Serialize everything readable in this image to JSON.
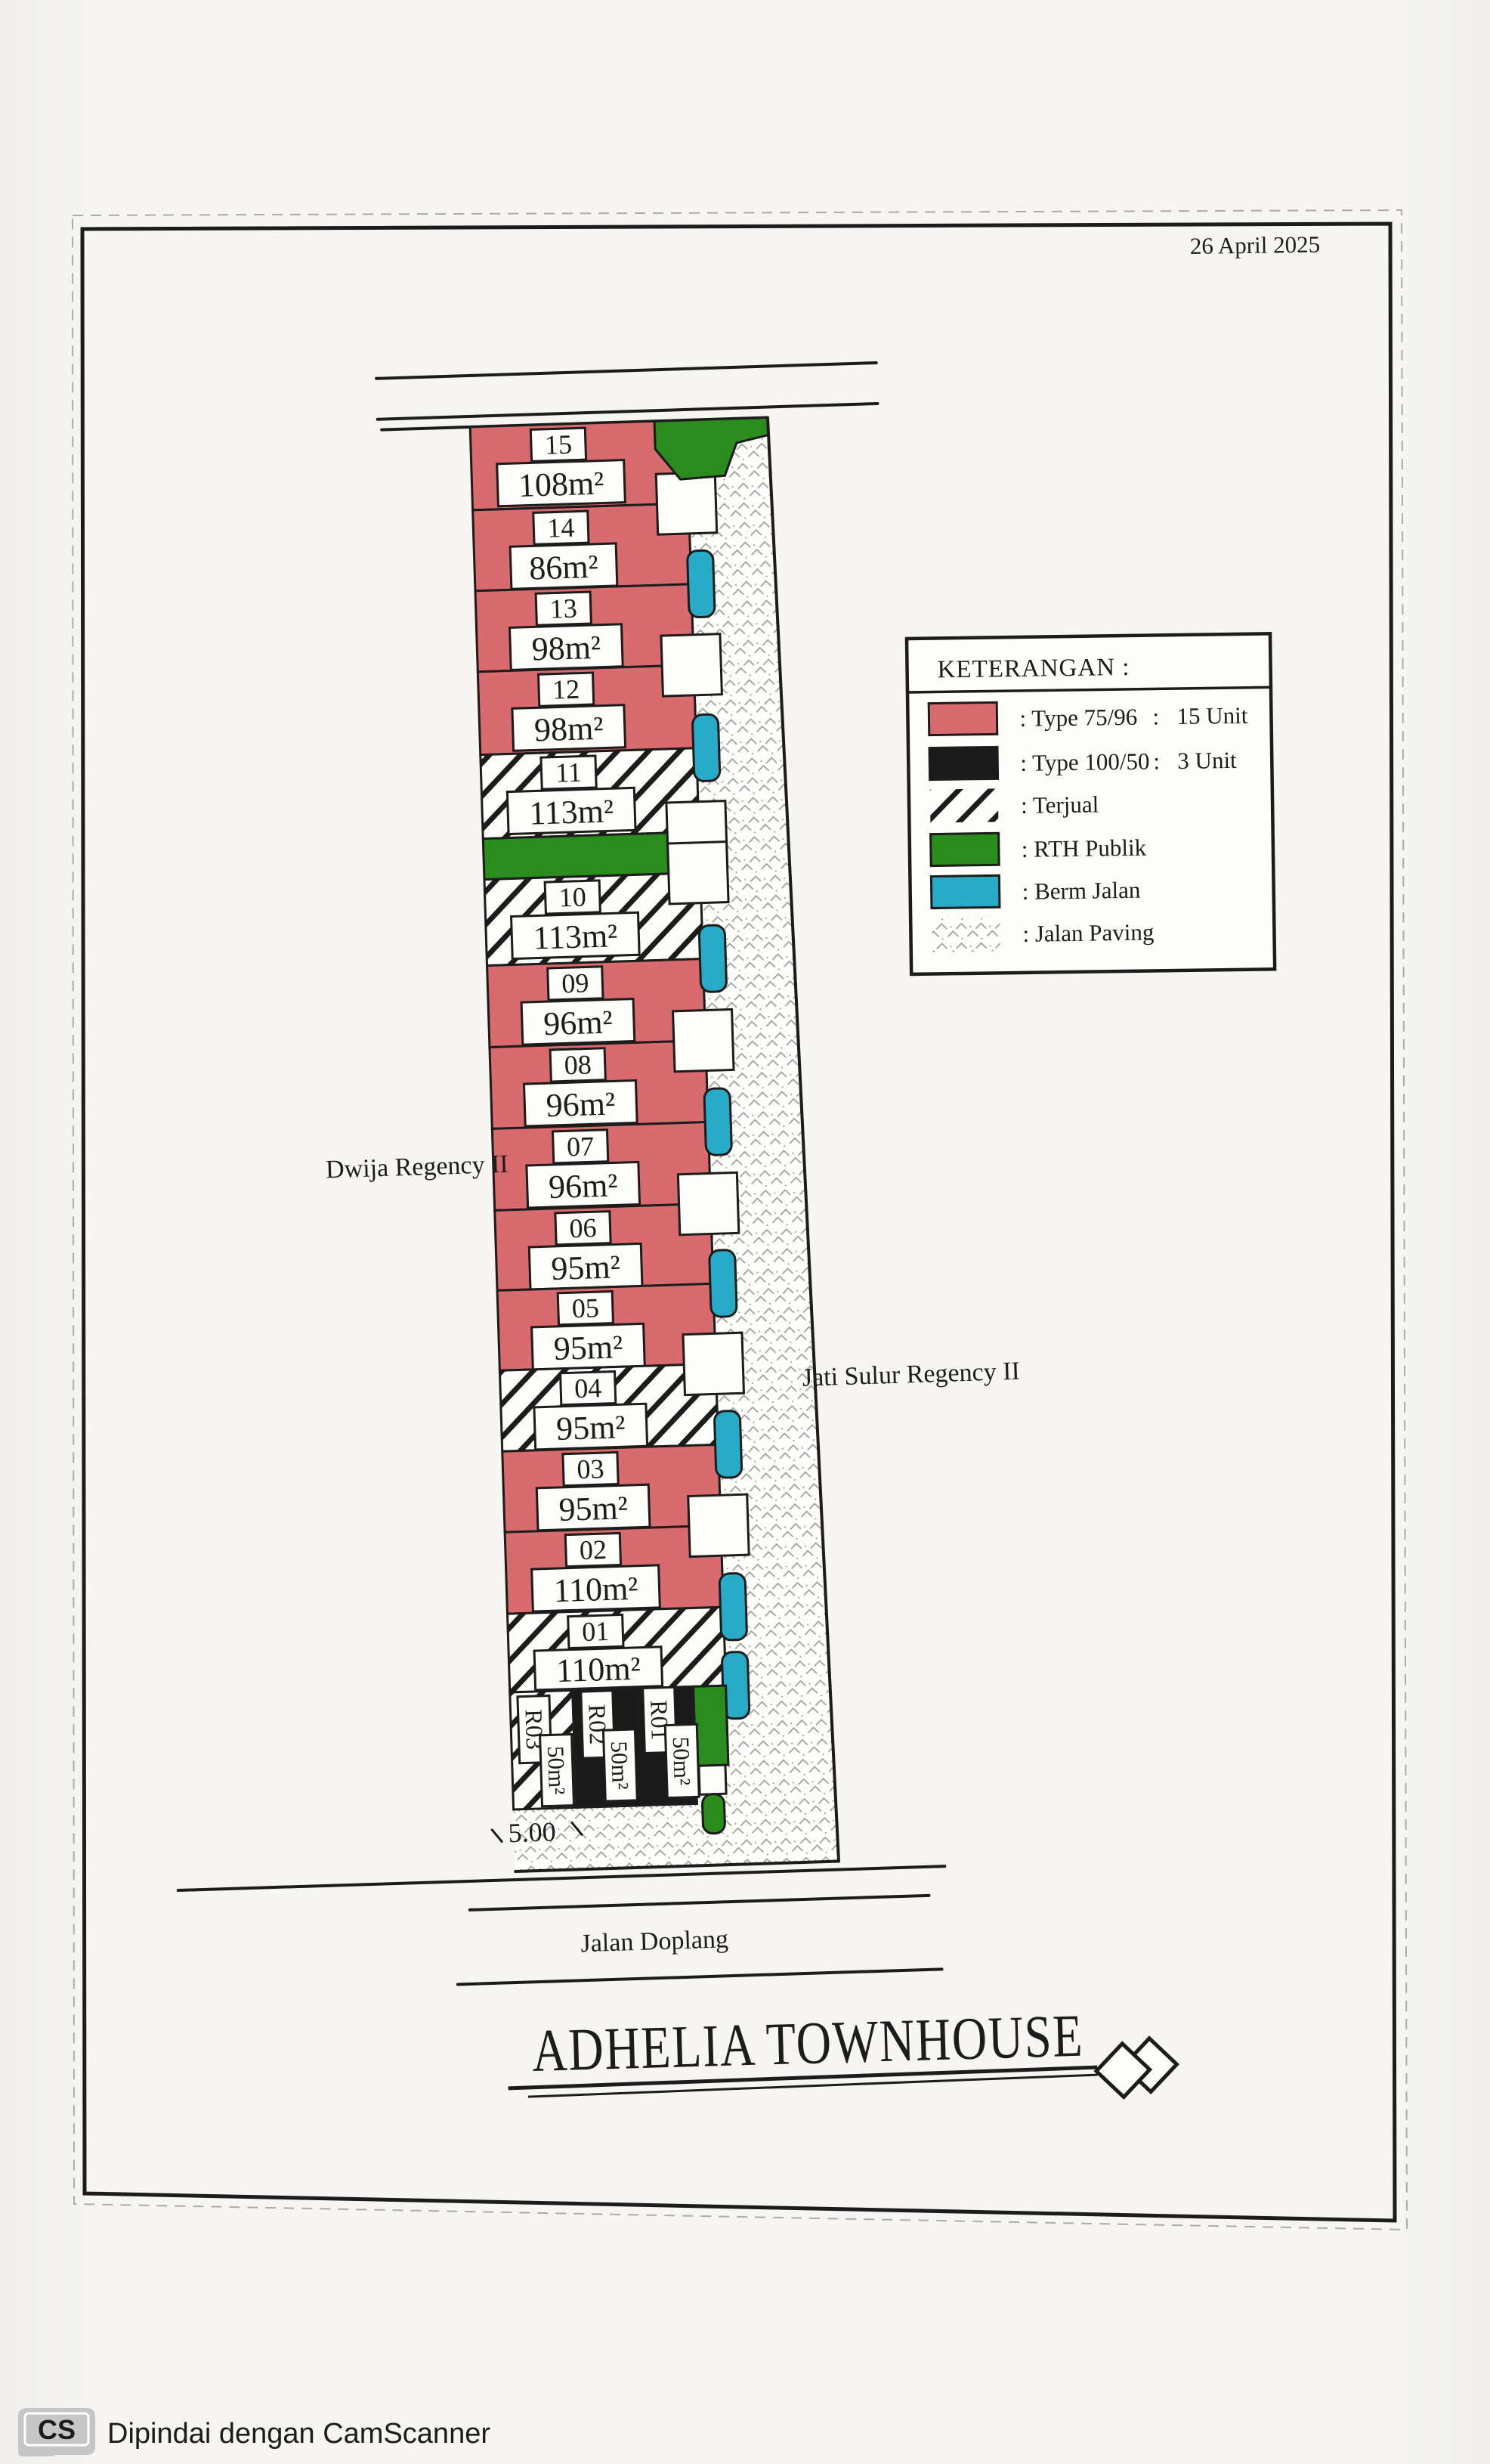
{
  "document": {
    "date": "26 April 2025",
    "title": "ADHELIA TOWNHOUSE",
    "scanner": {
      "badge": "CS",
      "text": "Dipindai dengan CamScanner"
    }
  },
  "legend": {
    "title": "KETERANGAN  :",
    "entries": [
      {
        "swatch": "type-75-96",
        "label": ": Type 75/96",
        "sep": ":",
        "count": "15 Unit"
      },
      {
        "swatch": "type-100-50",
        "label": ": Type 100/50",
        "sep": ":",
        "count": "3 Unit"
      },
      {
        "swatch": "terjual",
        "label": ": Terjual"
      },
      {
        "swatch": "rth-publik",
        "label": ": RTH Publik"
      },
      {
        "swatch": "berm-jalan",
        "label": ": Berm Jalan"
      },
      {
        "swatch": "jalan-paving",
        "label": ": Jalan Paving"
      }
    ]
  },
  "plan": {
    "neighbors": {
      "left": "Dwija Regency II",
      "right": "Jati Sulur Regency II"
    },
    "streets": {
      "bottom": "Jalan Doplang"
    },
    "dimension": "5.00",
    "lots": [
      {
        "no": "15",
        "area": "108m²",
        "status": "type 75/96"
      },
      {
        "no": "14",
        "area": "86m²",
        "status": "type 75/96"
      },
      {
        "no": "13",
        "area": "98m²",
        "status": "type 75/96"
      },
      {
        "no": "12",
        "area": "98m²",
        "status": "type 75/96"
      },
      {
        "no": "11",
        "area": "113m²",
        "status": "terjual"
      },
      {
        "no": "10",
        "area": "113m²",
        "status": "terjual"
      },
      {
        "no": "09",
        "area": "96m²",
        "status": "type 75/96"
      },
      {
        "no": "08",
        "area": "96m²",
        "status": "type 75/96"
      },
      {
        "no": "07",
        "area": "96m²",
        "status": "type 75/96"
      },
      {
        "no": "06",
        "area": "95m²",
        "status": "type 75/96"
      },
      {
        "no": "05",
        "area": "95m²",
        "status": "type 75/96"
      },
      {
        "no": "04",
        "area": "95m²",
        "status": "terjual"
      },
      {
        "no": "03",
        "area": "95m²",
        "status": "type 75/96"
      },
      {
        "no": "02",
        "area": "110m²",
        "status": "type 75/96"
      },
      {
        "no": "01",
        "area": "110m²",
        "status": "terjual"
      },
      {
        "no": "R03",
        "area": "50m²",
        "status": "terjual"
      },
      {
        "no": "R02",
        "area": "50m²",
        "status": "type 100/50"
      },
      {
        "no": "R01",
        "area": "50m²",
        "status": "type 100/50"
      }
    ]
  },
  "colors": {
    "ink": "#1c1c1c",
    "paper": "#f5f4f0",
    "paper-box": "#fdfdfa",
    "red": "#d96b6e",
    "black-lot": "#1a1a1a",
    "green": "#2a8c1d",
    "teal": "#28abc7",
    "paving-ink": "#8f8f96",
    "watermark": "#c3c3c3"
  }
}
